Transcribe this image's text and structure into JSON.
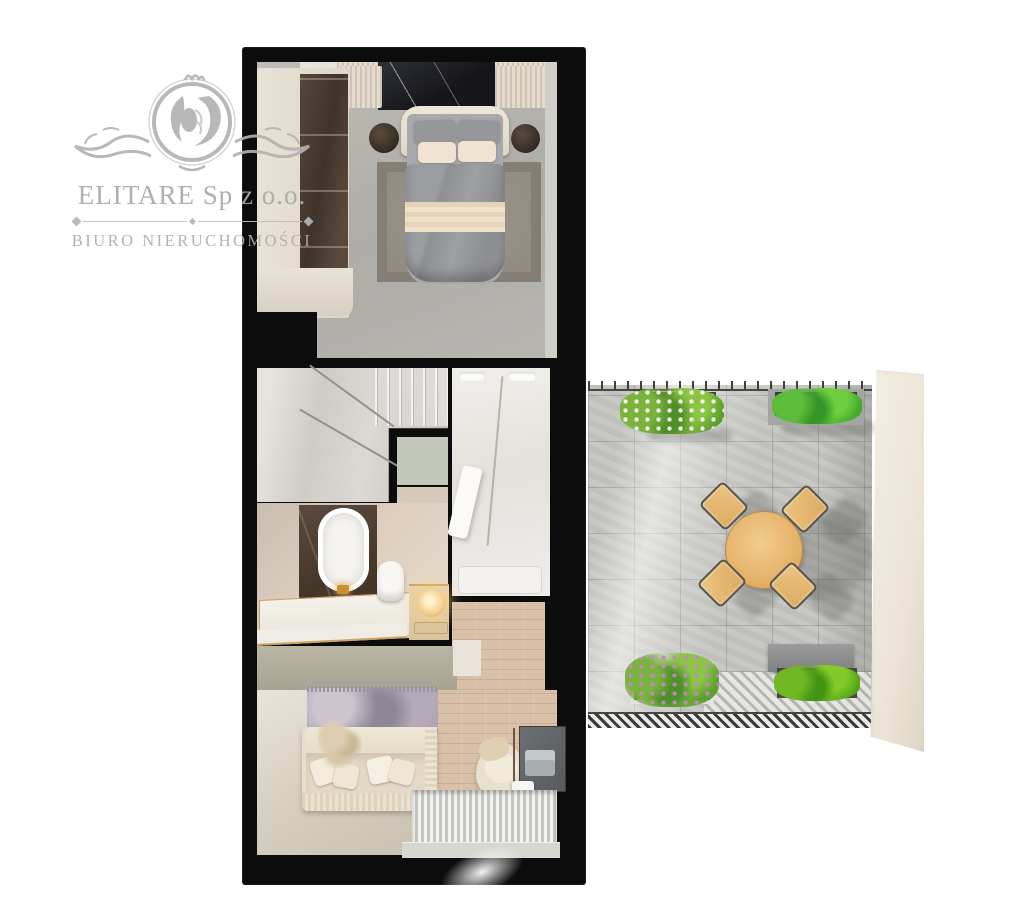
{
  "watermark": {
    "title": "ELITARE Sp z o.o.",
    "subtitle": "BIURO NIERUCHOMOŚCI",
    "logo": "lion-crest-icon",
    "text_color": "#aaaaaa"
  },
  "floorplan": {
    "type": "apartment-top-down-3d-render",
    "background": "#ffffff",
    "wall_color": "#0c0c0d",
    "rooms": [
      {
        "name": "bedroom",
        "position": "top",
        "floor": "concrete-grey",
        "floor_color": "#b3b1ac",
        "items": [
          "wardrobe-sliding-doors",
          "double-bed",
          "headboard",
          "grey-duvet",
          "cream-blanket-band",
          "pillows",
          "nightstand-left",
          "nightstand-right",
          "area-rug",
          "black-marble-wall-panel",
          "ribbed-radiator-panels"
        ]
      },
      {
        "name": "staircase",
        "position": "middle-left",
        "floor": "marble",
        "floor_color": "#d6d3ce",
        "items": [
          "winder-stairs",
          "steps"
        ]
      },
      {
        "name": "bathroom",
        "position": "middle-left",
        "floor_color": "#dccfc0",
        "items": [
          "freestanding-oval-bathtub",
          "gold-faucet",
          "marble-platform-gold-trim",
          "toilet",
          "vanity-counter",
          "glowing-sphere-lamp"
        ]
      },
      {
        "name": "shower-room",
        "position": "middle-right",
        "floor": "white-marble",
        "floor_color": "#eceae6",
        "items": [
          "shower-tray",
          "towel-bench",
          "ceiling-vents"
        ]
      },
      {
        "name": "hallway",
        "position": "middle-right-lower",
        "floor": "wood",
        "floor_color": "#d9c0a8",
        "items": []
      },
      {
        "name": "living-room",
        "position": "bottom",
        "floor_color": "#d2cbbc",
        "items": [
          "cream-sofa",
          "throw-pillows",
          "pampas-plant",
          "lilac-rug",
          "sideboard-sage",
          "armchair",
          "desk",
          "laptop",
          "printer",
          "slatted-deck-panel",
          "window-sill"
        ]
      }
    ],
    "terrace": {
      "position": "right",
      "floor": "stone-tile-grid",
      "tile_color": "#c4c5c1",
      "tile_size_px": 46,
      "items": [
        "round-wooden-dining-table",
        "four-wooden-chairs",
        "planter-white-flowers",
        "planter-green-shrubs-top",
        "planter-purple-flowers",
        "planter-green-shrubs-bottom",
        "grey-bench",
        "herringbone-deck-band",
        "top-railing",
        "bottom-railing",
        "privacy-wall"
      ],
      "table_color": "#e7bd76",
      "chair_color": "#e3b572",
      "wall_color": "#efe8da"
    },
    "palette": {
      "cream": "#e7decc",
      "beige_wall": "#d7c9ba",
      "dark_wood": "#4a3d34",
      "grey_duvet": "#97989c",
      "gold_accent": "#c9a35f",
      "sage": "#b6b1a0",
      "greenery": "#6fae36",
      "flower_white": "#ffffff",
      "flower_purple": "#c08ac4"
    }
  }
}
